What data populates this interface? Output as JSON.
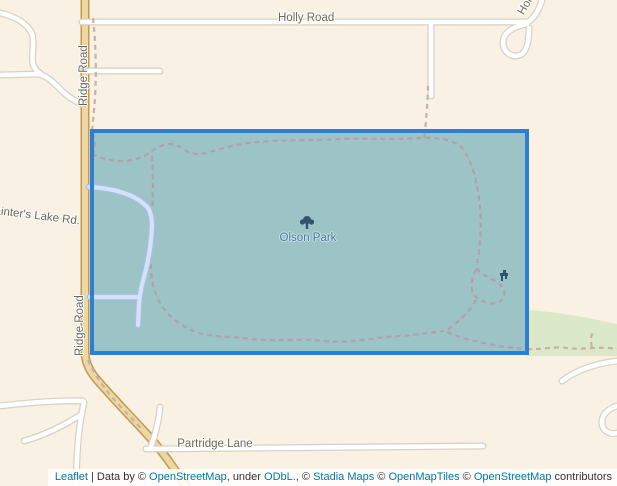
{
  "map": {
    "kind": "leaflet-map-with-selection",
    "labels": {
      "holly_road": "Holly Road",
      "holly_partial": "Hol",
      "ridge_road_upper": "Ridge Road",
      "ridge_road_lower": "Ridge Road",
      "painters_lake_rd": "Painter's Lake Rd.",
      "partridge_lane": "Partridge Lane",
      "park": "Olson Park"
    },
    "icons": {
      "park": "tree-icon",
      "poi": "picnic-site-icon"
    },
    "selection": {
      "shape": "rectangle",
      "x": 92,
      "y": 131,
      "width": 435,
      "height": 222,
      "border_color": "#2d7fd6",
      "fill_color": "#9cc3c6"
    },
    "colors": {
      "background": "#f8f1e4",
      "main_road_fill": "#ead9a4",
      "main_road_casing": "#c9964f",
      "minor_road_fill": "#ffffff",
      "minor_road_casing": "#d8d0c2",
      "trail_outside": "#c9b2a4",
      "trail_inside": "#b1a0a6",
      "green_area": "#dce9c8",
      "road_label": "#6d675c",
      "park_label": "#46799b",
      "inner_road_fill": "#d4e1f7",
      "inner_road_casing": "#a5c0e6"
    }
  },
  "attribution": {
    "leaflet_link": "Leaflet",
    "sep": " | Data by © ",
    "osm_link_1": "OpenStreetMap",
    "under_text": ", under ",
    "odbl_link": "ODbL.",
    "comma_text": ", © ",
    "stadia_link": "Stadia Maps",
    "copy_2": " © ",
    "openmaptiles_link": "OpenMapTiles",
    "copy_3": " © ",
    "osm_link_2": "OpenStreetMap",
    "contributors_text": " contributors",
    "link_color": "#0078a8"
  }
}
